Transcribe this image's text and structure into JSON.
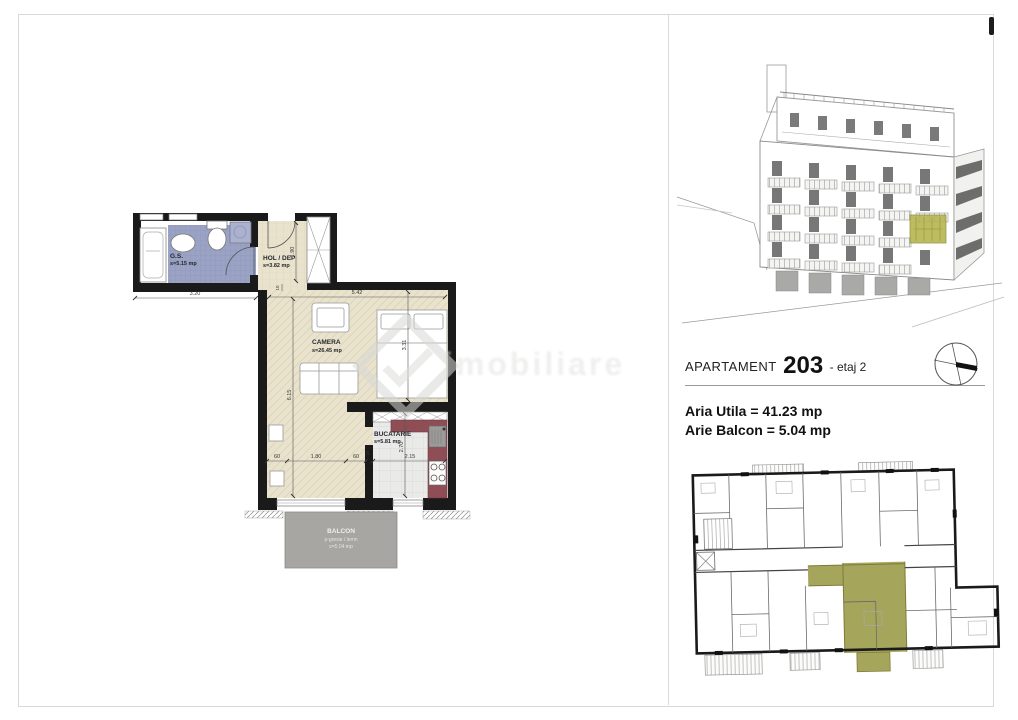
{
  "main_plan": {
    "rooms": {
      "gs": {
        "name": "G.S.",
        "area": "s=5.15 mp"
      },
      "hol": {
        "name": "HOL / DEP",
        "area": "s=3.82 mp"
      },
      "camera": {
        "name": "CAMERA",
        "area": "s=26.45 mp"
      },
      "bucatarie": {
        "name": "BUCATARIE",
        "area": "s=5.81 mp"
      },
      "balcon": {
        "name": "BALCON",
        "finish": "p-gresie / lemn",
        "area": "s=5.04 mp"
      }
    },
    "dims": {
      "gs_w": "3.20",
      "hol_h": "1.90",
      "hol_off": "10",
      "cam_w": "5.42",
      "cam_h": "6.15",
      "bed_w": "3.31",
      "win_l": "60",
      "win_c": "1.80",
      "win_r": "60",
      "kit_off": "15",
      "kit_w": "2.15",
      "kit_h": "2.70"
    },
    "watermark": "imobiliare"
  },
  "info_panel": {
    "title_label": "APARTAMENT",
    "title_number": "203",
    "title_suffix": "- etaj 2",
    "aria_utila": "Aria Utila = 41.23 mp",
    "arie_balcon": "Arie Balcon = 5.04 mp"
  },
  "colors": {
    "wall_black": "#1a1a1a",
    "floor_beige": "#e9e3cd",
    "bathroom_blue": "#9aa3c4",
    "kitchen_counter": "#8f4e55",
    "highlight_olive": "#a6a55c",
    "balcony_gray": "#b2b0ad"
  }
}
